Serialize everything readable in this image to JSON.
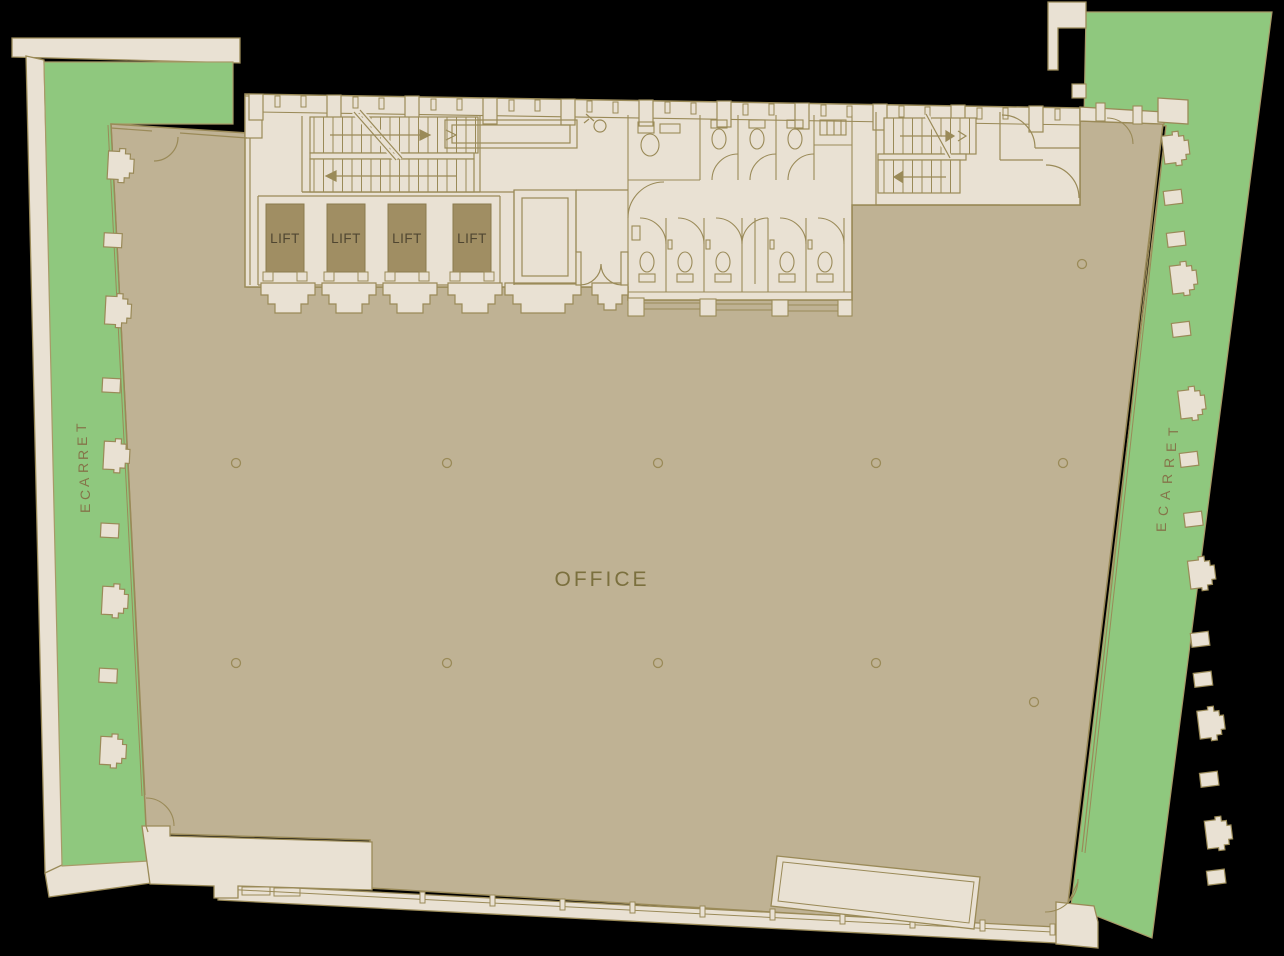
{
  "plan": {
    "title": "Office floor plan",
    "labels": {
      "office": "OFFICE",
      "terrace_left": "TERRACE",
      "terrace_right": "TERRACE"
    },
    "lifts": [
      {
        "label": "LIFT"
      },
      {
        "label": "LIFT"
      },
      {
        "label": "LIFT"
      },
      {
        "label": "LIFT"
      }
    ],
    "colors": {
      "background": "#000000",
      "terrace": "#8fc87e",
      "office_floor": "#bfb294",
      "core": "#e9e1d3",
      "wall_line": "#9a8a58",
      "lift_shaft": "#a08e63",
      "lift_text": "#4f4631",
      "room_text": "#7b703e",
      "terrace_text": "#85754a"
    }
  }
}
